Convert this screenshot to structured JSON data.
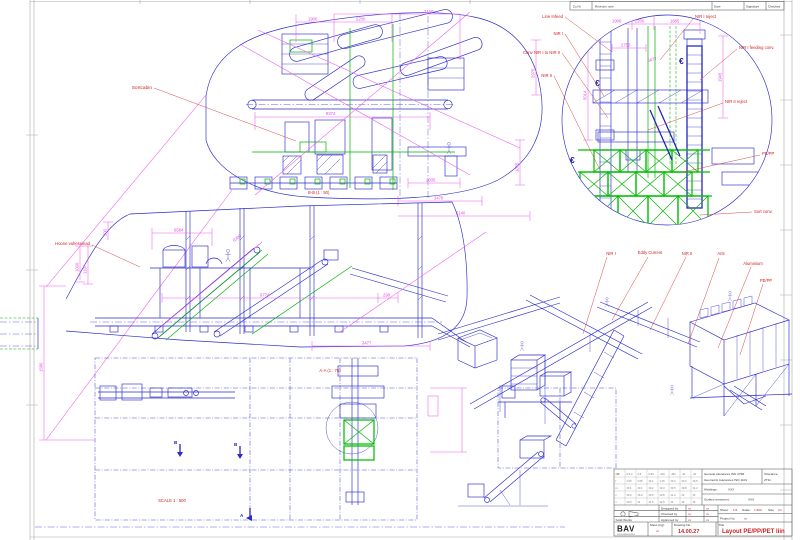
{
  "revision_table": {
    "headers": [
      "Zu.Nr",
      "Revision note",
      "Date",
      "Signature",
      "Checked"
    ]
  },
  "plan_view": {
    "callout_sortcabin": "Sortcabin",
    "section_bb": "B-B (1 : 50)",
    "dims": {
      "d1900": "1900",
      "d2200": "2200",
      "d7150": "7150",
      "d8374": "8374",
      "d2605": "2605",
      "d3478": "3478",
      "d5140": "5140",
      "d2975": "2975",
      "d1075": "1075"
    }
  },
  "detail_view": {
    "callouts": {
      "line_infeed": "Line Infeed",
      "nir1": "NIR I",
      "conv": "Conv NIR I to NIR II",
      "nir2": "NIR II",
      "nir1_reject": "NIR I reject",
      "nir1_feeding": "NIR I feeding conv.",
      "nir2_reject": "NIR II reject",
      "pepp": "PE/PP",
      "sort_conv": "Sort conv."
    },
    "dims": {
      "d1900": "1900",
      "d2200": "2200",
      "d1685": "1685",
      "d2750": "2750",
      "d5677": "5677",
      "d1945": "1945",
      "d5014": "5014"
    },
    "centroid_symbol": "€"
  },
  "side_view": {
    "callout": "Hoone vaheseinad",
    "dims": {
      "d6584": "6584",
      "d6300": "6300",
      "d9774": "9774",
      "d298": "298",
      "d3477": "3477",
      "d300": "300",
      "d1000": "1000",
      "d1197": "1197"
    }
  },
  "bottom_plan": {
    "section_aa": "A-A (1 : 75)",
    "scale_label": "SCALE 1 : 500",
    "marker_a": "A",
    "marker_b": "B"
  },
  "left_dim": {
    "value": "1580"
  },
  "iso_view": {
    "labels": {
      "nir1": "NIR I",
      "eddy": "Eddy Current",
      "nir2": "NIR II",
      "anti": "Anti",
      "alu": "Aluminium",
      "pepp": "PE/PP"
    }
  },
  "title_block": {
    "general_tol1": "General tolerances ISO 2768",
    "general_tol2": "Geometric tolerances ISO 1101",
    "tolerance_label": "Tolerance:",
    "tolerance_value": "2T11",
    "weldings_label": "Weldings:",
    "surface_label": "Surface treatment:",
    "xxx": "XXX",
    "designed_label": "Designed by",
    "checked_label": "Checked by",
    "approved_label": "Approved by",
    "xx": "xx",
    "sheet_label": "Sheet",
    "sheet_value": "1/3",
    "scale_label": "Scale:",
    "scale_value": "1:500",
    "size_label": "Size",
    "size_value": "A1",
    "project_label": "Project No.",
    "logo": "BAV",
    "logo_sub": "ENGINEERING",
    "solidworks": "Solid Works",
    "mass_label": "Mass (kg):",
    "drawing_no_label": "Drawing No.",
    "drawing_no_value": "14.00.27",
    "title_label": "Title",
    "title_value": "Layout PE/PP/PET liin",
    "tol_grid": [
      [
        "mm",
        "0.5-3",
        "3-6",
        "6-30",
        "-120",
        "-400",
        "-1k",
        "-2k"
      ],
      [
        "f",
        "±.05",
        "±.05",
        "±0.1",
        "±.15",
        "±0.2",
        "±0.3",
        "±0.5"
      ],
      [
        "m",
        "±0.1",
        "±0.1",
        "±0.2",
        "±0.3",
        "±0.5",
        "±0.8",
        "±1.2"
      ],
      [
        "c",
        "±0.2",
        "±0.3",
        "±0.5",
        "±0.8",
        "±1.2",
        "±2",
        "±3"
      ],
      [
        "v",
        "±0.5",
        "±1",
        "±1.5",
        "±2.5",
        "±4",
        "±6",
        "±8"
      ]
    ]
  }
}
